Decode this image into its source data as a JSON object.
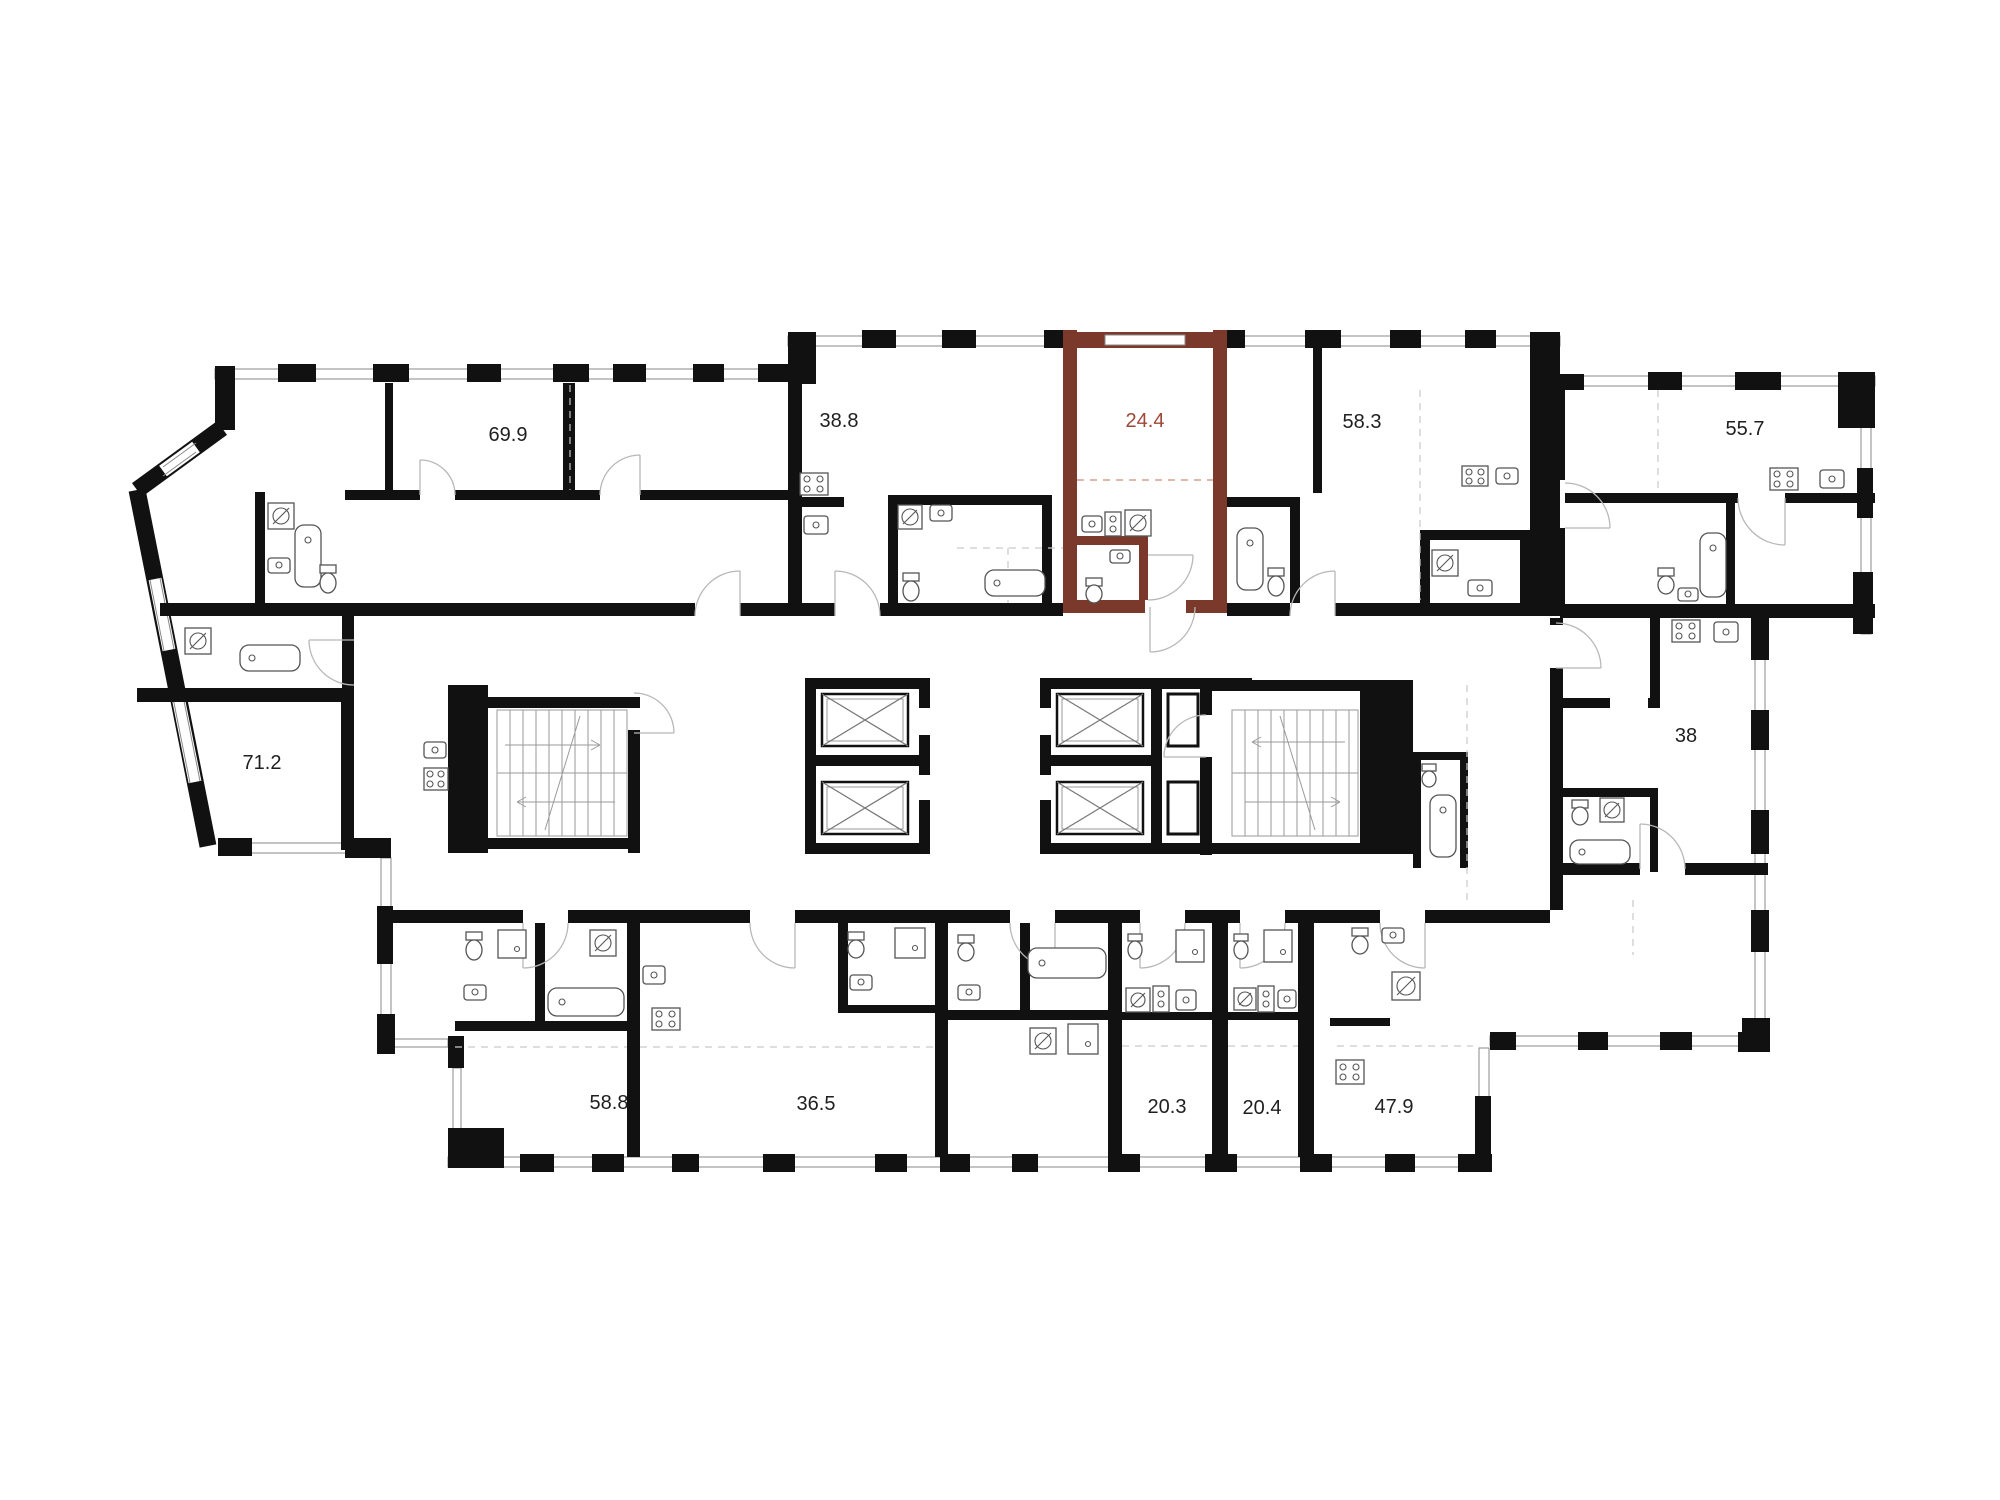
{
  "plan": {
    "background_color": "#ffffff",
    "wall_color": "#111111",
    "window_line_color": "#8a8a8a",
    "door_arc_color": "#b8b8b8",
    "fixture_line_color": "#555555",
    "label_color": "#1f1f1f",
    "highlight": {
      "unit": "24.4",
      "fill": "#f5a78f",
      "wall": "#7a392a",
      "label_color": "#9c4936"
    },
    "units": [
      {
        "id": "unit-69-9",
        "area": "69.9",
        "highlighted": false
      },
      {
        "id": "unit-38-8",
        "area": "38.8",
        "highlighted": false
      },
      {
        "id": "unit-24-4",
        "area": "24.4",
        "highlighted": true
      },
      {
        "id": "unit-58-3",
        "area": "58.3",
        "highlighted": false
      },
      {
        "id": "unit-55-7",
        "area": "55.7",
        "highlighted": false
      },
      {
        "id": "unit-71-2",
        "area": "71.2",
        "highlighted": false
      },
      {
        "id": "unit-38",
        "area": "38",
        "highlighted": false
      },
      {
        "id": "unit-58-8",
        "area": "58.8",
        "highlighted": false
      },
      {
        "id": "unit-36-5",
        "area": "36.5",
        "highlighted": false
      },
      {
        "id": "unit-20-3",
        "area": "20.3",
        "highlighted": false
      },
      {
        "id": "unit-20-4",
        "area": "20.4",
        "highlighted": false
      },
      {
        "id": "unit-47-9",
        "area": "47.9",
        "highlighted": false
      }
    ]
  }
}
